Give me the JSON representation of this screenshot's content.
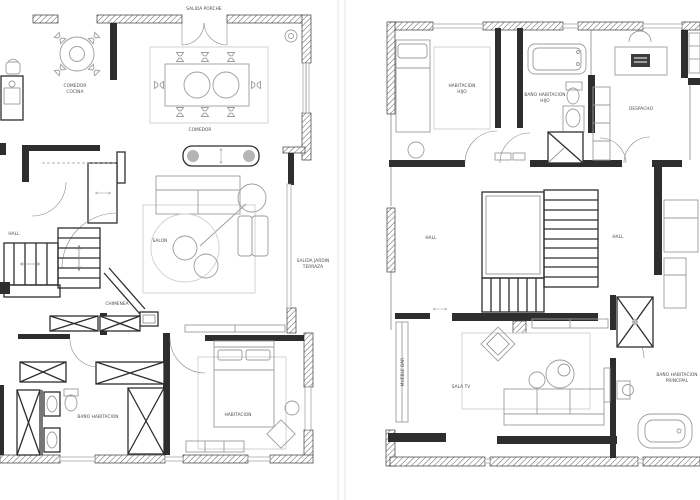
{
  "meta": {
    "image_type": "architectural floor plans, two storeys side by side",
    "background_color": "#ffffff",
    "wall_color": "#2e2e2e",
    "furniture_line_color": "#9c9c9c",
    "label_color": "#4d4d4d"
  },
  "plan_left": {
    "name": "ground floor plan",
    "labels": {
      "salida_porche": "SALIDA PORCHE",
      "comedor_cocina_line1": "COMEDOR",
      "comedor_cocina_line2": "COCINA",
      "comedor": "COMEDOR",
      "hall": "HALL",
      "salon": "SALON",
      "salida_jardin_line1": "SALIDA JARDIN",
      "salida_jardin_line2": "TERRAZA",
      "chimenea": "CHIMENEA",
      "bano_habitacion": "BAÑO HABITACION",
      "habitacion": "HABITACION"
    }
  },
  "plan_right": {
    "name": "first floor plan",
    "labels": {
      "habitacion_hijo_line1": "HABITACION",
      "habitacion_hijo_line2": "HIJO",
      "bano_hijo_line1": "BAÑO HABITACION",
      "bano_hijo_line2": "HIJO",
      "despacho": "DESPACHO",
      "hall_left": "HALL",
      "hall_right": "HALL",
      "mueble_bar": "MUEBLE BAR",
      "sala_tv": "SALA TV",
      "bano_principal_line1": "BAÑO HABITACION",
      "bano_principal_line2": "PRINCIPAL"
    }
  }
}
